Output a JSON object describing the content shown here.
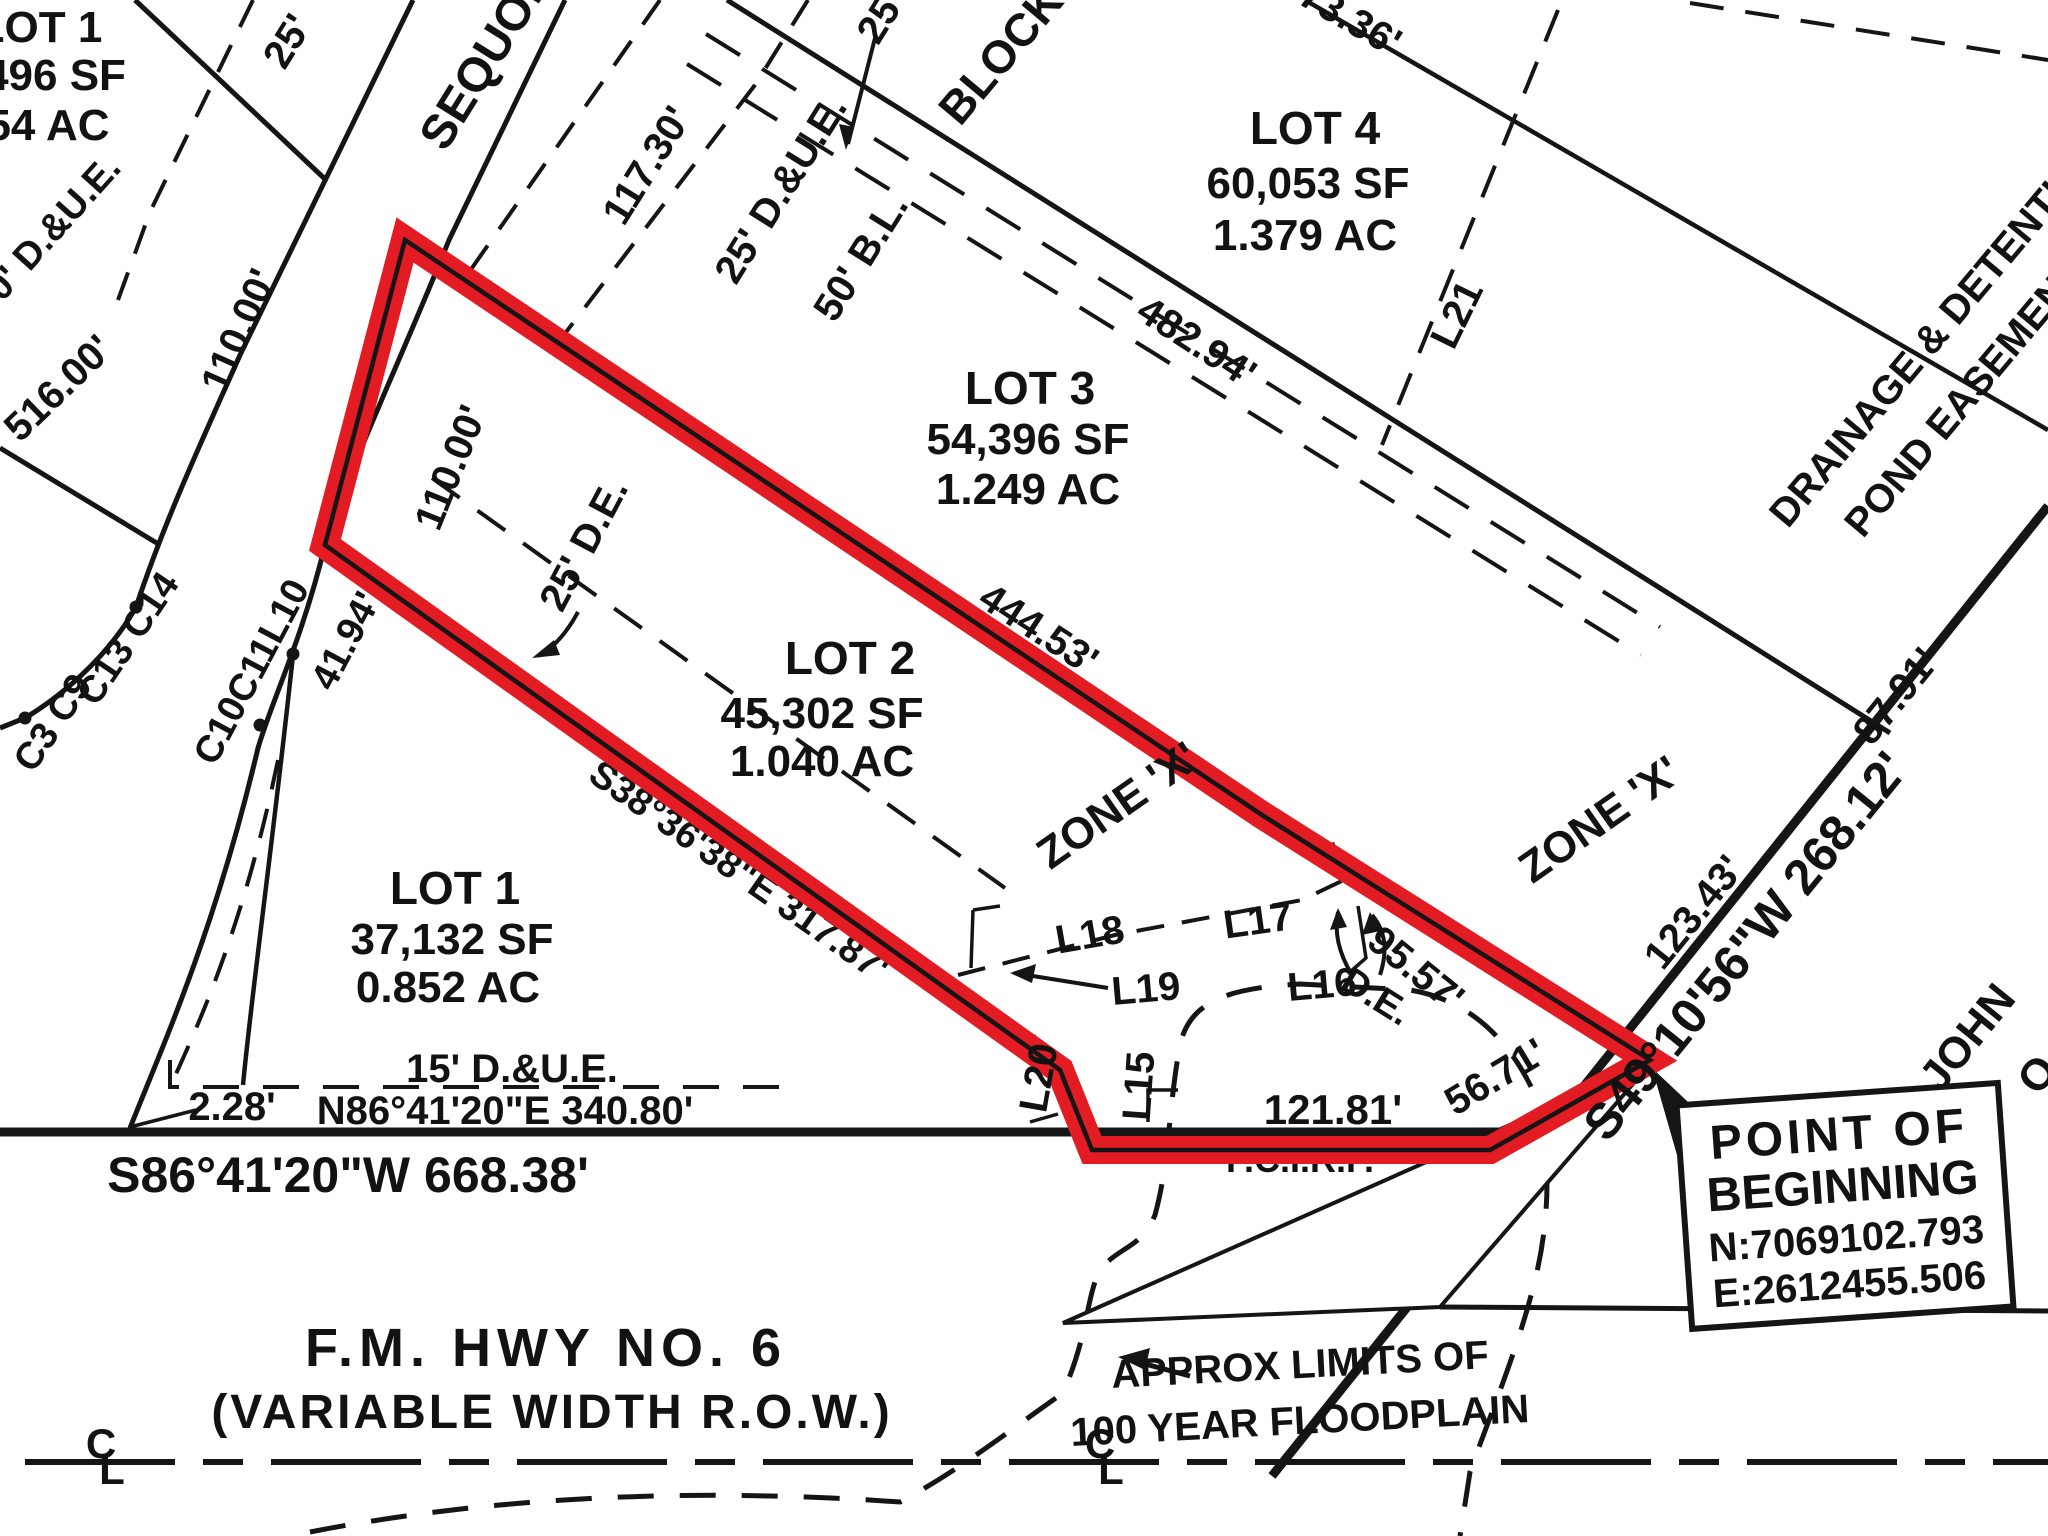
{
  "colors": {
    "highlight_red": "#e31b23",
    "line_black": "#151515",
    "floodplain_grey": "#9a9a9a",
    "background": "#ffffff"
  },
  "lots": {
    "lot1_partial": {
      "name": "LOT 1",
      "area_sf": "496 SF",
      "area_ac": "54 AC"
    },
    "lot1": {
      "name": "LOT 1",
      "area_sf": "37,132 SF",
      "area_ac": "0.852 AC"
    },
    "lot2": {
      "name": "LOT 2",
      "area_sf": "45,302 SF",
      "area_ac": "1.040 AC"
    },
    "lot3": {
      "name": "LOT 3",
      "area_sf": "54,396 SF",
      "area_ac": "1.249 AC"
    },
    "lot4": {
      "name": "LOT 4",
      "area_sf": "60,053 SF",
      "area_ac": "1.379 AC"
    },
    "block": "BLOCK"
  },
  "streets": {
    "sequoia": "SEQUOIA",
    "fm_hwy_name": "F.M. HWY NO. 6",
    "fm_hwy_row": "(VARIABLE WIDTH R.O.W.)"
  },
  "bearings": {
    "south_hwy": "S86°41'20\"W 668.38'",
    "lot1_north": "N86°41'20\"E 340.80'",
    "lot2_sw": "S38°36'38\"E 317.87'",
    "east_row": "S49°10'56\"W 268.12'"
  },
  "dimensions": {
    "d110_street": "110.00'",
    "d110_frontage": "110.00'",
    "d516": "516.00'",
    "d117": "117.30'",
    "d482": "482.94'",
    "d444": "444.53'",
    "d673": "673.36'",
    "d95": "95.57'",
    "d123": "123.43'",
    "d87": "87.91'",
    "d56": "56.71'",
    "d121": "121.81'",
    "d41": "41.94'",
    "d2": "2.28'",
    "d25_top": "25'",
    "d25_left": "25'"
  },
  "easements": {
    "due0": "0' D.&U.E.",
    "due25": "25' D.&U.E.",
    "bl50": "50' B.L.",
    "de25": "25' D.E.",
    "due15": "15' D.&U.E.",
    "de": "D.E.",
    "drainage_line1": "DRAINAGE & DETENTION",
    "drainage_line2": "POND EASEMENT"
  },
  "line_labels": {
    "l15": "L15",
    "l16": "L16",
    "l17": "L17",
    "l18": "L18",
    "l19": "L19",
    "l20": "L20",
    "l21": "L21"
  },
  "curve_labels": {
    "c3_c9": "C3 C9",
    "c13_c14": "C13 C14",
    "c10_c11_l10": "C10C11L10"
  },
  "zones": {
    "zone_x_1": "ZONE 'X'",
    "zone_x_2": "ZONE 'X'"
  },
  "pob": {
    "line1": "POINT OF",
    "line2": "BEGINNING",
    "northing": "N:7069102.793",
    "easting": "E:2612455.506"
  },
  "floodplain": {
    "label_line1": "APPROX LIMITS OF",
    "label_line2": "100 YEAR FLOODPLAIN"
  },
  "monument": "F.C.I.R.F.",
  "owner": "JOHN",
  "owner_cut": "O",
  "centerline": {
    "c": "C",
    "l": "L"
  }
}
